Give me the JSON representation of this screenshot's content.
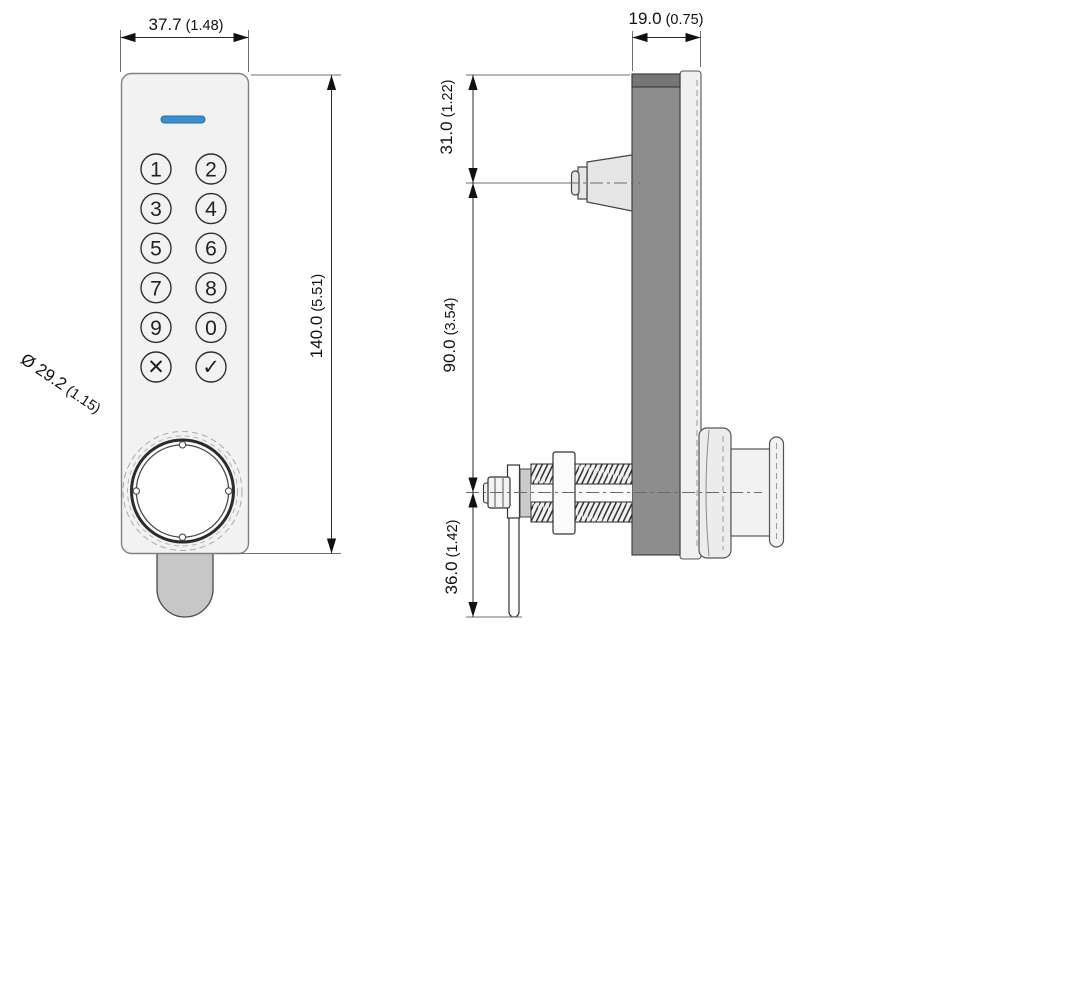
{
  "drawing": {
    "type": "technical-drawing",
    "subject": "digital keypad cam lock, front and side orthographic views",
    "front_view": {
      "width_dim": {
        "mm": "37.7",
        "inch": "(1.48)"
      },
      "height_dim": {
        "mm": "140.0",
        "inch": "(5.51)"
      },
      "diameter_dim": {
        "mm": "Ø 29.2",
        "inch": "(1.15)"
      },
      "keys": [
        "1",
        "2",
        "3",
        "4",
        "5",
        "6",
        "7",
        "8",
        "9",
        "0",
        "✕",
        "✓"
      ],
      "indicator_color": "#3b8fd1"
    },
    "side_view": {
      "depth_dim": {
        "mm": "19.0",
        "inch": "(0.75)"
      },
      "top_offset_dim": {
        "mm": "31.0",
        "inch": "(1.22)"
      },
      "body_length_dim": {
        "mm": "90.0",
        "inch": "(3.54)"
      },
      "cam_length_dim": {
        "mm": "36.0",
        "inch": "(1.42)"
      }
    },
    "colors": {
      "panel_fill": "#f2f2f2",
      "panel_stroke": "#808080",
      "indicator_blue": "#3b8fd1",
      "side_body_dark": "#8d8d8d",
      "side_body_top": "#767676",
      "cam_tab_gray": "#c7c7c7",
      "line_color": "#2b2b2b"
    }
  }
}
